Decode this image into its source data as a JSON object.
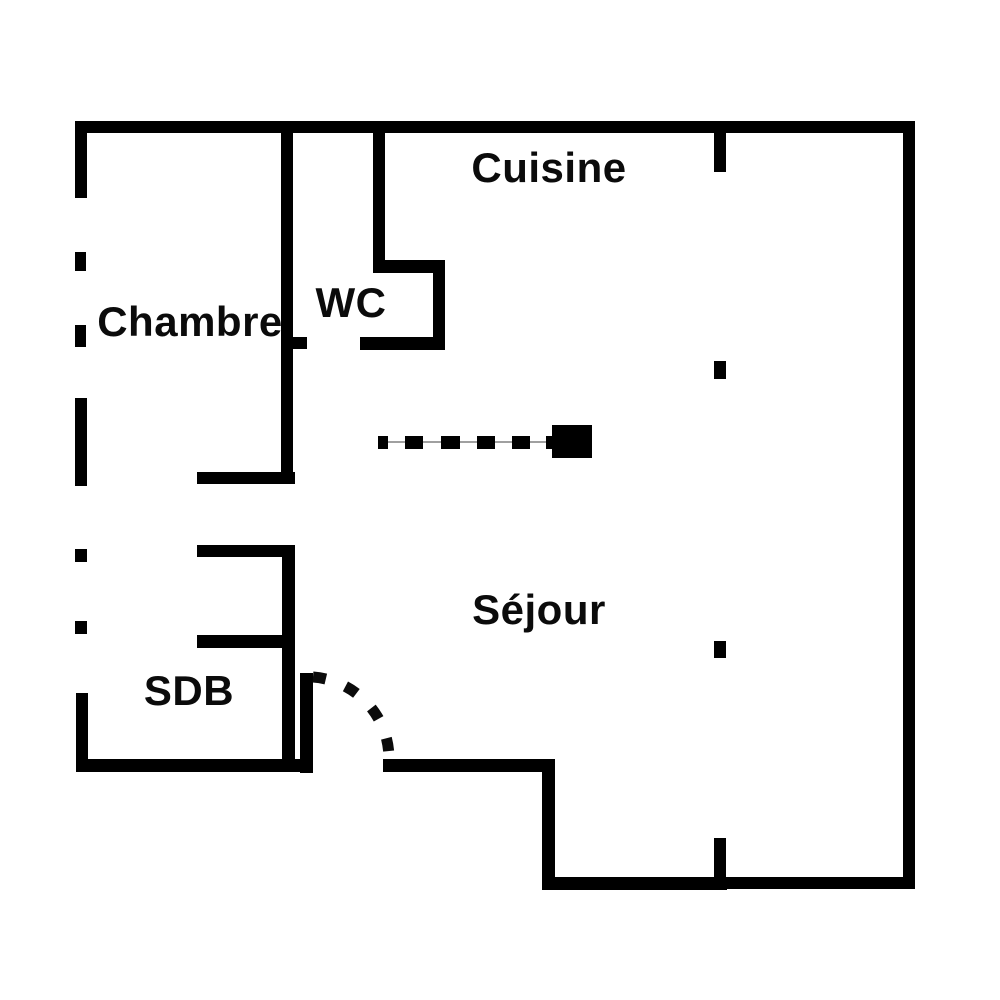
{
  "colors": {
    "wall": "#000000",
    "background": "#ffffff",
    "guide_line": "#a0a0a0"
  },
  "rooms": [
    {
      "id": "cuisine",
      "label": "Cuisine"
    },
    {
      "id": "chambre",
      "label": "Chambre"
    },
    {
      "id": "wc",
      "label": "WC"
    },
    {
      "id": "sejour",
      "label": "Séjour"
    },
    {
      "id": "sdb",
      "label": "SDB"
    }
  ]
}
